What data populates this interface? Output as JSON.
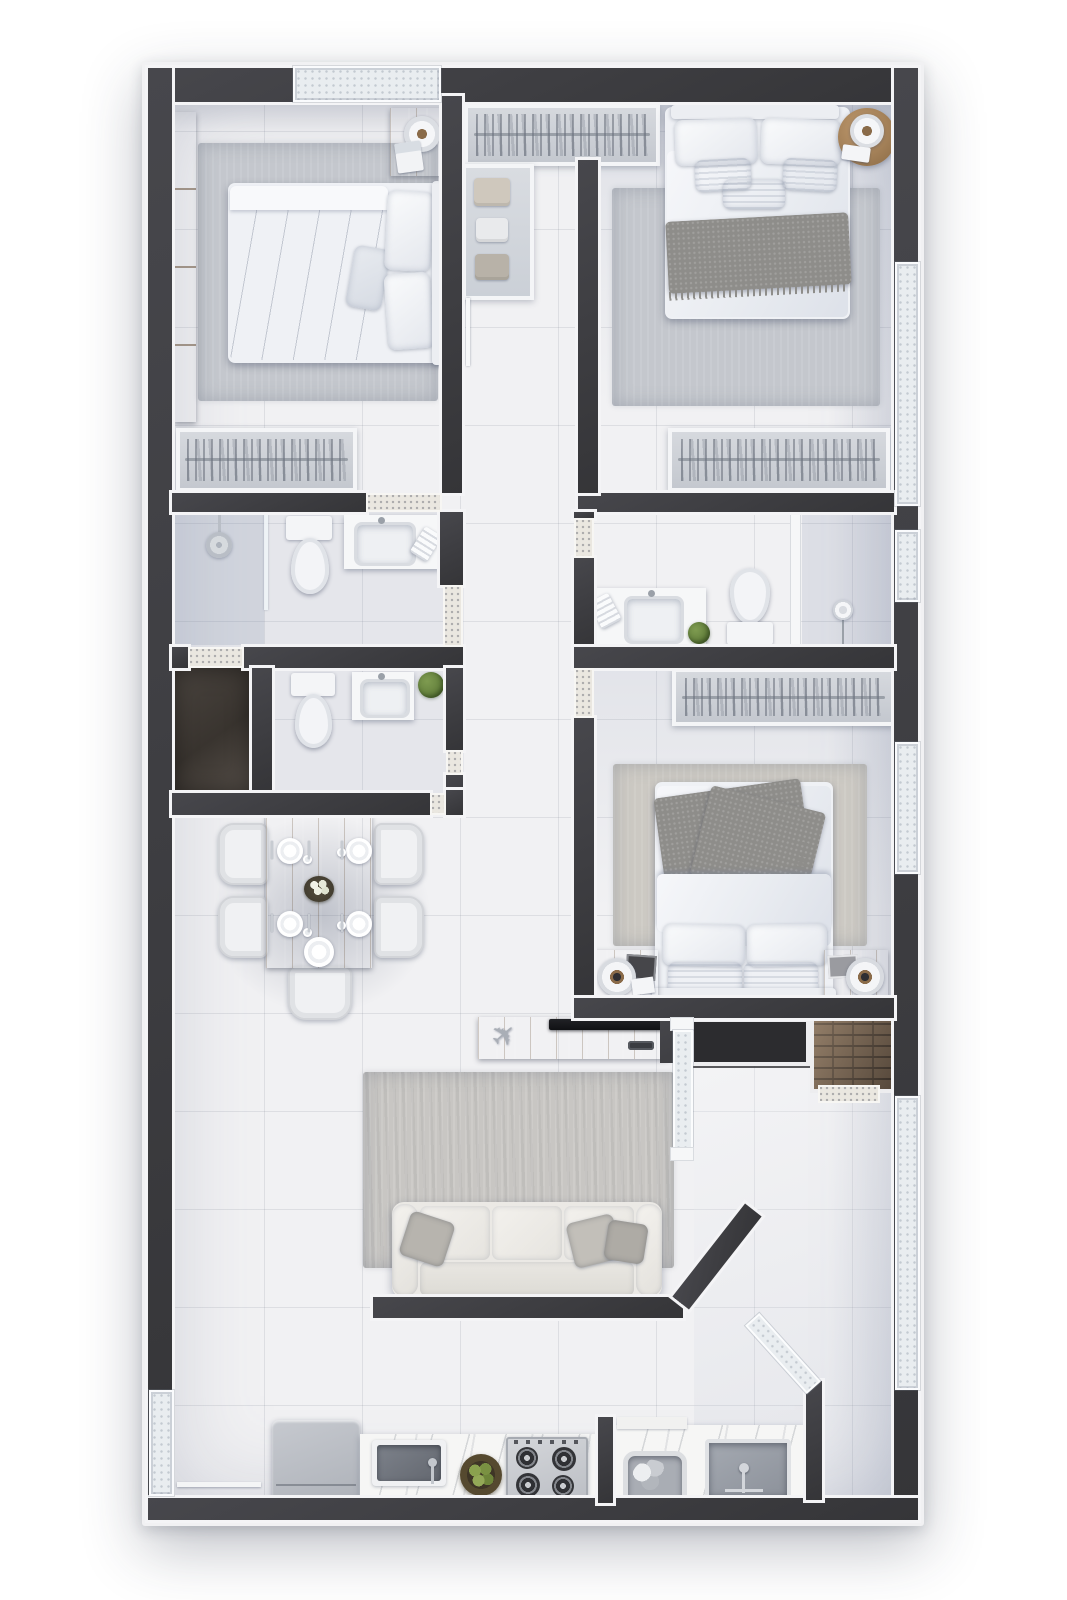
{
  "scene": {
    "kind": "apartment-floor-plan-3d-top-view",
    "style": "photorealistic render, no text labels",
    "plan_margin_background": "#ffffff"
  },
  "colors": {
    "wall": "#353538",
    "wall-hi": "#47474c",
    "liner": "#f4f4f6",
    "floor-a": "#e7e8ec",
    "floor-b": "#dcdee3",
    "floor-c": "#ccd1da",
    "terrazzo": "#eae7e0",
    "glass": "#e9edf0",
    "wood-a": "#b78f66",
    "wood-b": "#9c7850",
    "rug": "#c8c6c3",
    "rug-bed": "#c4c7cd",
    "rug-warm": "#ccc9c3",
    "linen": "#eff1f5",
    "throw": "#8e8d8a",
    "sofa": "#ebe9e5",
    "plant": "#547031",
    "shaft": "#2c2c2f",
    "brick": "#6f5d4c",
    "brick-joint": "#453a31"
  },
  "icons": {
    "airplane": "✈"
  },
  "rooms": [
    {
      "id": "bedroom-1",
      "furniture": [
        "wardrobe-panel",
        "double-bed",
        "pillows",
        "nightstand",
        "table-lamp",
        "magazine",
        "area-rug",
        "closet-rack"
      ]
    },
    {
      "id": "walk-in-closet",
      "furniture": [
        "hanging-rack",
        "shelf-unit",
        "folded-clothes"
      ]
    },
    {
      "id": "bedroom-2",
      "furniture": [
        "double-bed",
        "pillows",
        "knit-throw",
        "round-side-table",
        "table-lamp",
        "book",
        "area-rug",
        "closet-rack"
      ]
    },
    {
      "id": "bathroom-1",
      "furniture": [
        "shower",
        "shower-glass",
        "toilet",
        "vanity-sink",
        "towel"
      ]
    },
    {
      "id": "storage-closet",
      "furniture": []
    },
    {
      "id": "bathroom-2",
      "furniture": [
        "toilet",
        "vanity-sink",
        "plant"
      ]
    },
    {
      "id": "bathroom-3",
      "furniture": [
        "vanity-sink",
        "towel",
        "plant",
        "toilet",
        "partition",
        "floor-lamp"
      ]
    },
    {
      "id": "bedroom-3",
      "furniture": [
        "double-bed",
        "knit-throw",
        "pillows",
        "nightstand-left",
        "nightstand-right",
        "speakers",
        "photo-frames",
        "area-rug",
        "closet-rack"
      ]
    },
    {
      "id": "dining-area",
      "furniture": [
        "dining-table",
        "chairs",
        "plates",
        "glasses",
        "cutlery",
        "flower-centerpiece"
      ]
    },
    {
      "id": "living-area",
      "furniture": [
        "tv-console",
        "tv",
        "remote-control",
        "airplane-decor",
        "area-rug",
        "sofa-3-seat",
        "throw-pillows"
      ]
    },
    {
      "id": "balcony",
      "furniture": [
        "sliding-glass-door",
        "diagonal-glass-door"
      ]
    },
    {
      "id": "kitchen",
      "furniture": [
        "refrigerator",
        "counter",
        "sink",
        "faucet",
        "fruit-bowl",
        "gas-stove-4-burner"
      ]
    },
    {
      "id": "laundry",
      "furniture": [
        "counter",
        "wash-basin-with-clothes",
        "laundry-tub",
        "faucet"
      ]
    },
    {
      "id": "service-shaft",
      "furniture": []
    },
    {
      "id": "brick-shaft",
      "furniture": []
    }
  ]
}
